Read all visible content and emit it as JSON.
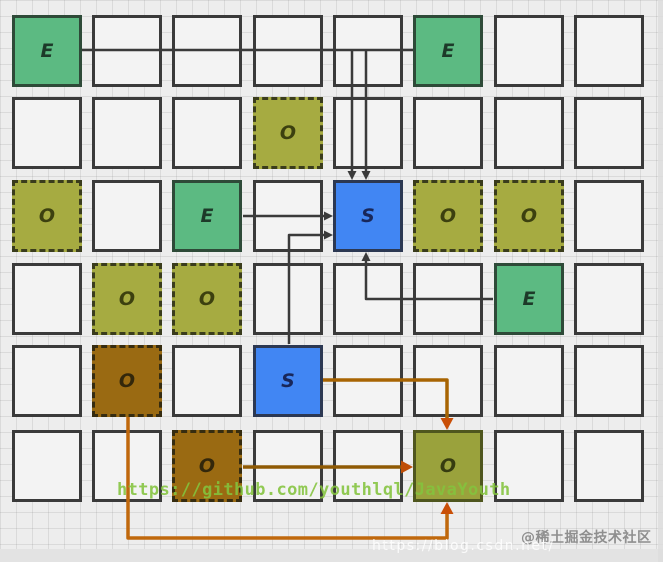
{
  "grid": {
    "rows": 6,
    "cols": 8
  },
  "cells": [
    {
      "row": 1,
      "col": 1,
      "label": "E",
      "kind": "e"
    },
    {
      "row": 1,
      "col": 6,
      "label": "E",
      "kind": "e"
    },
    {
      "row": 2,
      "col": 4,
      "label": "O",
      "kind": "o-dashed"
    },
    {
      "row": 3,
      "col": 1,
      "label": "O",
      "kind": "o-dashed"
    },
    {
      "row": 3,
      "col": 3,
      "label": "E",
      "kind": "e"
    },
    {
      "row": 3,
      "col": 5,
      "label": "S",
      "kind": "s"
    },
    {
      "row": 3,
      "col": 6,
      "label": "O",
      "kind": "o-dashed"
    },
    {
      "row": 3,
      "col": 7,
      "label": "O",
      "kind": "o-dashed"
    },
    {
      "row": 4,
      "col": 2,
      "label": "O",
      "kind": "o-dashed"
    },
    {
      "row": 4,
      "col": 3,
      "label": "O",
      "kind": "o-dashed"
    },
    {
      "row": 4,
      "col": 7,
      "label": "E",
      "kind": "e"
    },
    {
      "row": 5,
      "col": 2,
      "label": "O",
      "kind": "o-brown"
    },
    {
      "row": 5,
      "col": 4,
      "label": "S",
      "kind": "s"
    },
    {
      "row": 6,
      "col": 3,
      "label": "O",
      "kind": "o-brown"
    },
    {
      "row": 6,
      "col": 6,
      "label": "O",
      "kind": "o-solid"
    }
  ],
  "colors": {
    "cell_green": "#5cba82",
    "cell_olive": "#a6ab41",
    "cell_blue": "#4186f3",
    "cell_brown": "#9a6a12",
    "cell_olive_solid": "#9aa23c",
    "arrow_dark": "#3a3a3a",
    "arrow_orange": "#b4650a",
    "arrow_orange_dark": "#8f5a04",
    "arrow_head_orange": "#c94f07",
    "watermark_green": "#84c43e",
    "watermark_gray": "#8f8f8f"
  },
  "arrows": [
    {
      "name": "e-top-left-bus",
      "color": "#3a3a3a",
      "width": 2.5,
      "head": false,
      "points": [
        [
          82,
          50
        ],
        [
          413,
          50
        ]
      ]
    },
    {
      "name": "bus-drop-into-s-left",
      "color": "#3a3a3a",
      "width": 2.5,
      "head": true,
      "head_len": 9,
      "head_w": 4.5,
      "head_color": "#3a3a3a",
      "points": [
        [
          352,
          50
        ],
        [
          352,
          171
        ]
      ]
    },
    {
      "name": "bus-drop-into-s-right",
      "color": "#3a3a3a",
      "width": 2.5,
      "head": true,
      "head_len": 9,
      "head_w": 4.5,
      "head_color": "#3a3a3a",
      "points": [
        [
          366,
          50
        ],
        [
          366,
          171
        ]
      ]
    },
    {
      "name": "e-mid-to-s",
      "color": "#3a3a3a",
      "width": 2.5,
      "head": true,
      "head_len": 9,
      "head_w": 4.5,
      "head_color": "#3a3a3a",
      "points": [
        [
          243,
          216
        ],
        [
          324,
          216
        ]
      ]
    },
    {
      "name": "s-lower-to-s-upper",
      "color": "#3a3a3a",
      "width": 2.5,
      "head": true,
      "head_len": 9,
      "head_w": 4.5,
      "head_color": "#3a3a3a",
      "points": [
        [
          289,
          344
        ],
        [
          289,
          235
        ],
        [
          324,
          235
        ]
      ]
    },
    {
      "name": "e-right-to-s-bottom",
      "color": "#3a3a3a",
      "width": 2.5,
      "head": true,
      "head_len": 9,
      "head_w": 4.5,
      "head_color": "#3a3a3a",
      "points": [
        [
          493,
          299
        ],
        [
          366,
          299
        ],
        [
          366,
          261
        ]
      ]
    },
    {
      "name": "s-lower-to-o-final-top",
      "color": "#a86402",
      "width": 3.5,
      "head": true,
      "head_len": 12,
      "head_w": 6.5,
      "head_color": "#c94f07",
      "points": [
        [
          323,
          380
        ],
        [
          447,
          380
        ],
        [
          447,
          418
        ]
      ]
    },
    {
      "name": "o-brown1-to-o-final-bottom",
      "color": "#c0680c",
      "width": 3.5,
      "head": true,
      "head_len": 12,
      "head_w": 6.5,
      "head_color": "#c94f07",
      "points": [
        [
          128,
          417
        ],
        [
          128,
          538
        ],
        [
          447,
          538
        ],
        [
          447,
          514
        ]
      ]
    },
    {
      "name": "o-brown2-to-o-final-left",
      "color": "#8f5a04",
      "width": 3.5,
      "head": true,
      "head_len": 12,
      "head_w": 6.5,
      "head_color": "#bf4e06",
      "points": [
        [
          243,
          467
        ],
        [
          401,
          467
        ]
      ]
    }
  ],
  "watermarks": {
    "github": "https://github.com/youthlql/JavaYouth",
    "csdn": "https://blog.csdn.net/",
    "juejin": "@稀土掘金技术社区"
  }
}
